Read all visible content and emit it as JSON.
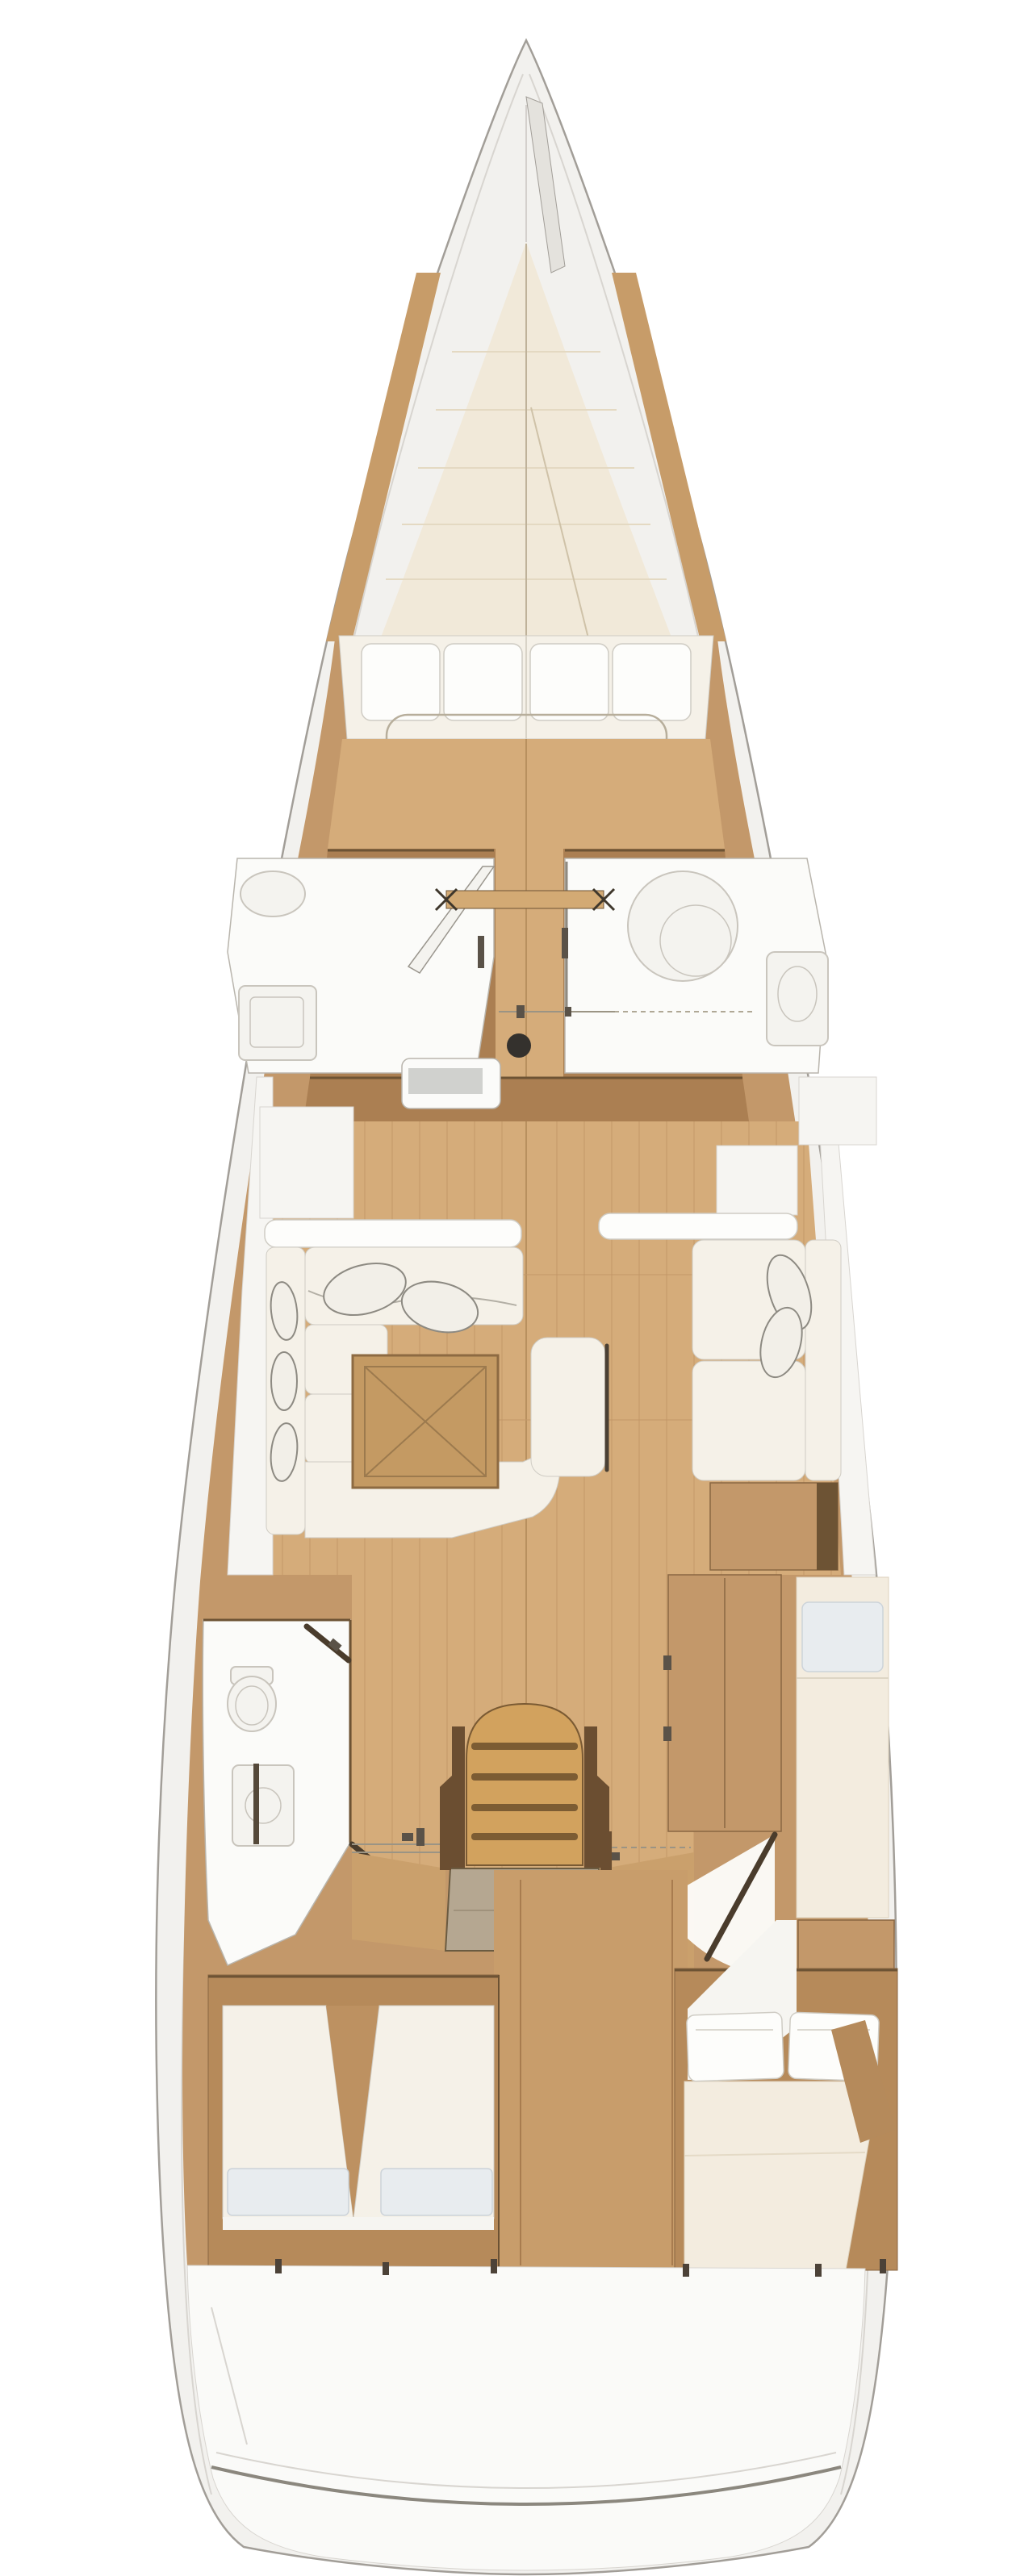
{
  "meta": {
    "type": "sailing-yacht-interior-floor-plan",
    "view": "top-down",
    "orientation": "bow-up"
  },
  "palette": {
    "bg": "#ffffff",
    "hullFill": "#f2f1ee",
    "hullStroke": "#a29e98",
    "deckLine": "#d8d5d0",
    "bowFit": "#e4e2dd",
    "creamDeck": "#f1e9d9",
    "creamLine": "#e4d9c2",
    "beam": "#c79c69",
    "floorLight": "#d5ac7a",
    "floorSeam": "#c29768",
    "seamDark": "#b8905f",
    "woodMid": "#c3986a",
    "woodEdge": "#8a6743",
    "woodDark": "#ab7f52",
    "woodDeep": "#6d5334",
    "roomWhite": "#fbfbf9",
    "roomStroke": "#b9b5ad",
    "fixture": "#c9c5bd",
    "fixFill": "#f4f3ef",
    "mattress": "#f5f1e8",
    "pillowWhite": "#fdfdfb",
    "pillowStroke": "#cfccc4",
    "palePillow": "#e8ecef",
    "paleStroke": "#ccd3d9",
    "cushLine": "#b3afa5",
    "tossFill": "#f2efe8",
    "tossStroke": "#8d8a82",
    "tableFill": "#c49a63",
    "tableEdge": "#8d6a42",
    "tableLine": "#9c7a4e",
    "stairGold": "#d2a25e",
    "stairEdge": "#7a5a33",
    "stairShadow": "#7c5c33",
    "railDark": "#6b4e31",
    "hatchGray": "#b5a791",
    "hatchEdge": "#6b5b41",
    "whiteBand": "#f6f5f2",
    "cream2": "#f3ecdf",
    "cream2Edge": "#ddd2bd",
    "doorLeaf": "#4a3c2c",
    "doorLine": "#9b9484",
    "doorBar": "#d3aa74",
    "hardware": "#5a5248",
    "hardwareDark": "#3f372c",
    "grayInset": "#d0d1ce",
    "sternWhite": "#fafaf8",
    "tickDark": "#4c4238",
    "mast": "#34312d",
    "transom": "#8b877e"
  },
  "areas": {
    "hull": "Hull and deck",
    "forepeak": "Forepeak locker",
    "forward_cabin": "Owner cabin with V-berth",
    "port_forward_head": "Port forward shower room",
    "starboard_forward_head": "Starboard forward head",
    "mast": "Mast step",
    "salon": "Salon",
    "salon_table": "Folding salon table",
    "center_bench": "Center bench seat",
    "port_settee": "Port L-shaped settee",
    "starboard_settee": "Starboard settee",
    "port_aft_head": "Port aft head",
    "companionway": "Companionway steps",
    "engine_hatch": "Engine compartment hatch",
    "wardrobe": "Starboard wardrobe",
    "starboard_berth": "Starboard aft single berth",
    "port_aft_cabin": "Port aft cabin twin berths",
    "starboard_aft_cabin": "Starboard aft cabin double berth",
    "stern": "Stern deck and transom"
  }
}
